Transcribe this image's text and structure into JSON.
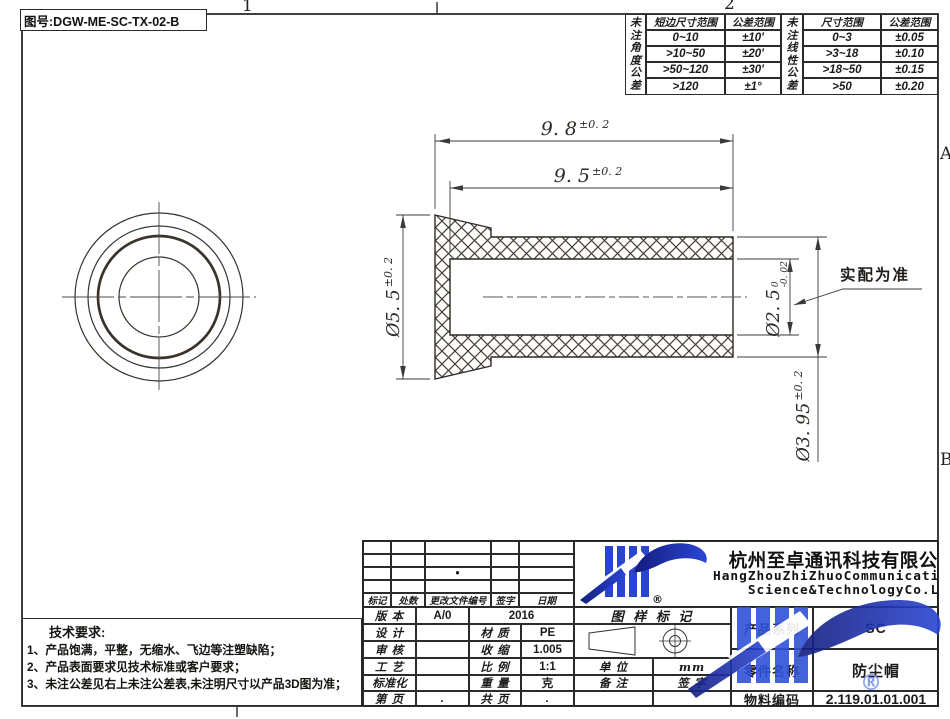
{
  "sheet": {
    "drawing_no": "图号:DGW-ME-SC-TX-02-B",
    "zones": {
      "top1": "1",
      "top2": "2",
      "rightA": "A",
      "rightB": "B"
    }
  },
  "angle_table": {
    "side_header": "未注角度公差",
    "col1": "短边尺寸范围",
    "col2": "公差范围",
    "rows": [
      [
        "0~10",
        "±10'"
      ],
      [
        ">10~50",
        "±20'"
      ],
      [
        ">50~120",
        "±30'"
      ],
      [
        ">120",
        "±1°"
      ]
    ]
  },
  "linear_table": {
    "side_header": "未注线性公差",
    "col1": "尺寸范围",
    "col2": "公差范围",
    "rows": [
      [
        "0~3",
        "±0.05"
      ],
      [
        ">3~18",
        "±0.10"
      ],
      [
        ">18~50",
        "±0.15"
      ],
      [
        ">50",
        "±0.20"
      ]
    ]
  },
  "dims": {
    "overall": {
      "value": "9. 8",
      "tol": "±0. 2"
    },
    "depth": {
      "value": "9. 5",
      "tol": "±0. 2"
    },
    "flange": {
      "value": "Ø5. 5",
      "tol": "±0. 2"
    },
    "bore": {
      "value": "Ø2. 5",
      "tol_upper": "0",
      "tol_lower": "-0. 02"
    },
    "body": {
      "value": "Ø3. 95",
      "tol": "±0. 2"
    },
    "fit_note": "实配为准"
  },
  "tech": {
    "title": "技术要求:",
    "items": [
      "1、产品饱满，平整，无缩水、飞边等注塑缺陷；",
      "2、产品表面要求见技术标准或客户要求；",
      "3、未注公差见右上未注公差表,未注明尺寸以产品3D图为准；"
    ]
  },
  "tb": {
    "rev_dot": "•",
    "hdr": {
      "mark": "标记",
      "count": "处数",
      "file": "更改文件编号",
      "sign": "签字",
      "date": "日期"
    },
    "version_label": "版 本",
    "version": "A/0",
    "year": "2016",
    "design_label": "设 计",
    "material_label": "材 质",
    "material": "PE",
    "check_label": "审 核",
    "shrink_label": "收 缩",
    "shrink": "1.005",
    "process_label": "工 艺",
    "scale_label": "比 例",
    "scale": "1:1",
    "standard_label": "标准化",
    "weight_label": "重 量",
    "weight": "克",
    "page_label": "第 页",
    "page": ".",
    "pages_label": "共 页",
    "pages": ".",
    "mark_header": "图 样 标 记",
    "unit_label": "单 位",
    "unit": "mm",
    "remark_label": "备 注",
    "sign_label": "签 字",
    "company_cn": "杭州至卓通讯科技有限公司",
    "company_en1": "HangZhouZhiZhuoCommunication",
    "company_en2": "Science&TechnologyCo.Ltd",
    "registered": "®",
    "series_label": "产品系列",
    "series": "SC",
    "part_label": "零件名称",
    "part": "防尘帽",
    "code_label": "物料编码",
    "code": "2.119.01.01.001"
  }
}
